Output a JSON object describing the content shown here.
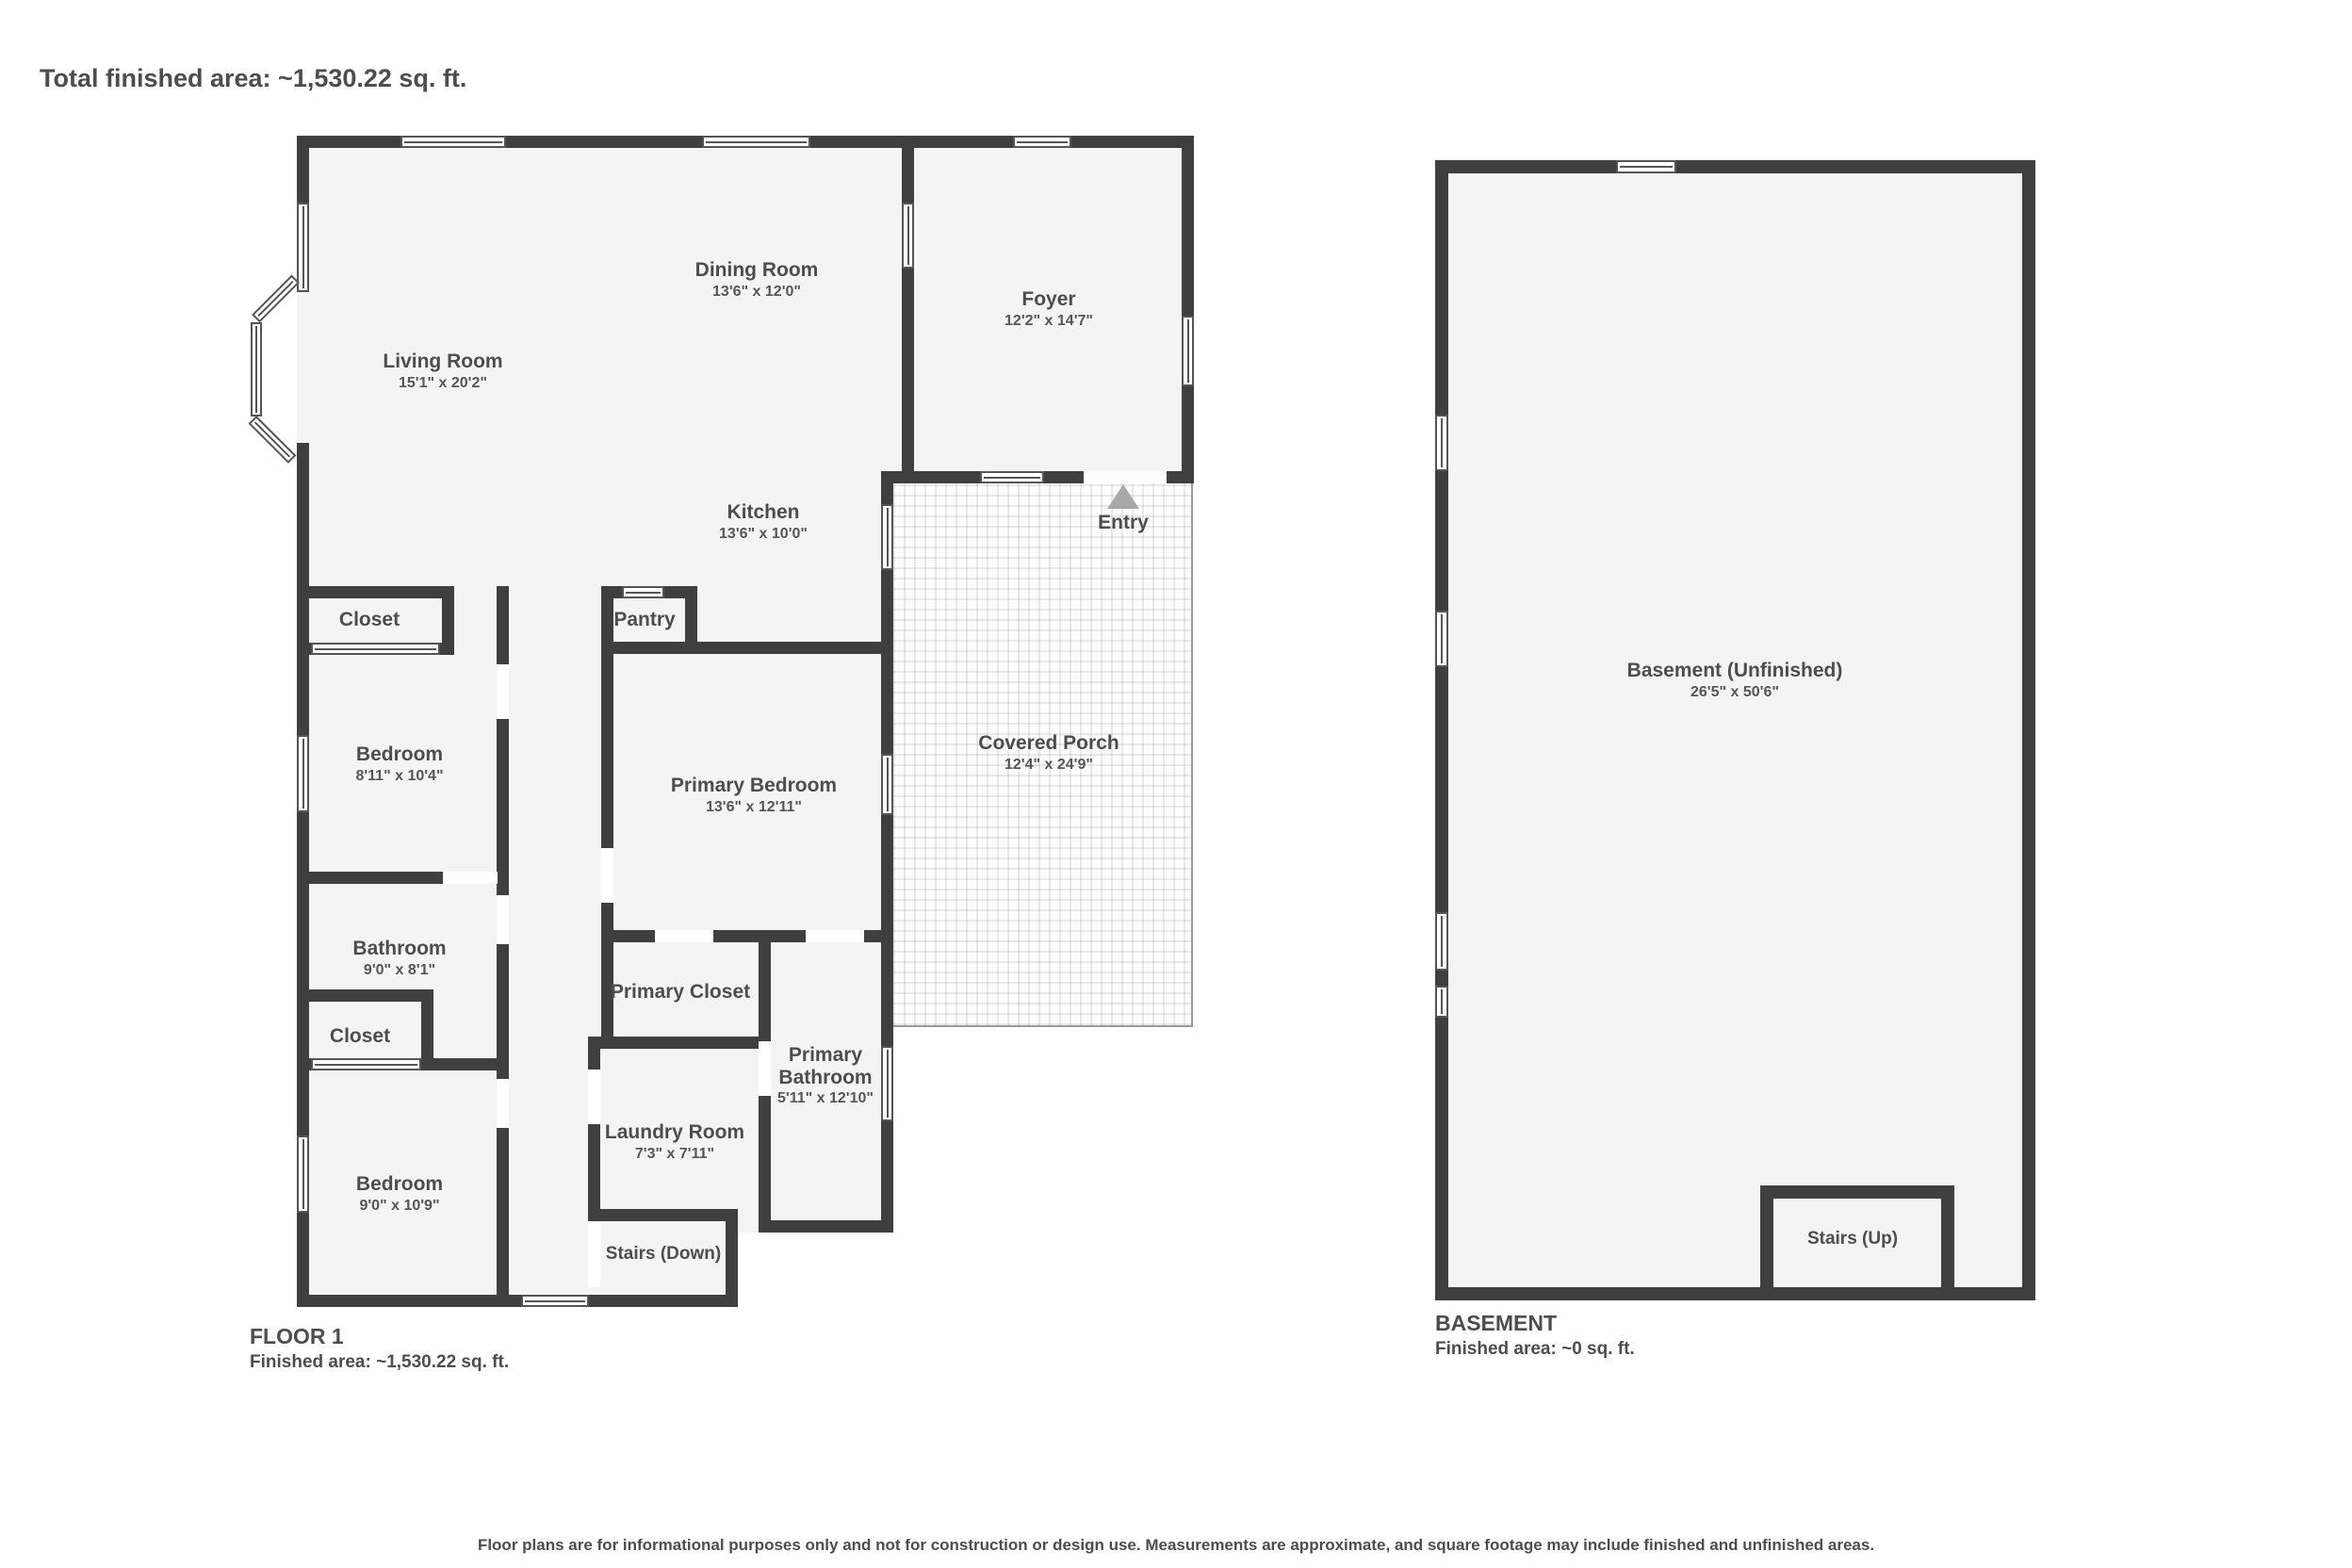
{
  "title": "Total finished area: ~1,530.22 sq. ft.",
  "colors": {
    "wall": "#3f3f3f",
    "floor": "#f4f4f4",
    "text": "#4d4d4d",
    "porch_line": "#9a9a9a",
    "entry_arrow": "#a8a8a8"
  },
  "floor1": {
    "label": "FLOOR 1",
    "area_label": "Finished area: ~1,530.22 sq. ft.",
    "rooms": {
      "living": {
        "name": "Living Room",
        "dims": "15'1\" x 20'2\""
      },
      "dining": {
        "name": "Dining Room",
        "dims": "13'6\" x 12'0\""
      },
      "foyer": {
        "name": "Foyer",
        "dims": "12'2\" x 14'7\""
      },
      "kitchen": {
        "name": "Kitchen",
        "dims": "13'6\" x 10'0\""
      },
      "entry": {
        "name": "Entry"
      },
      "porch": {
        "name": "Covered Porch",
        "dims": "12'4\" x 24'9\""
      },
      "closet_top": {
        "name": "Closet"
      },
      "pantry": {
        "name": "Pantry"
      },
      "bedroom1": {
        "name": "Bedroom",
        "dims": "8'11\" x 10'4\""
      },
      "primary_bedroom": {
        "name": "Primary Bedroom",
        "dims": "13'6\" x 12'11\""
      },
      "bathroom": {
        "name": "Bathroom",
        "dims": "9'0\" x 8'1\""
      },
      "closet_mid": {
        "name": "Closet"
      },
      "primary_closet": {
        "name": "Primary Closet"
      },
      "primary_bathroom": {
        "name": "Primary Bathroom",
        "dims": "5'11\" x 12'10\""
      },
      "bedroom2": {
        "name": "Bedroom",
        "dims": "9'0\" x 10'9\""
      },
      "laundry": {
        "name": "Laundry Room",
        "dims": "7'3\" x 7'11\""
      },
      "stairs_down": {
        "name": "Stairs (Down)"
      }
    }
  },
  "basement": {
    "label": "BASEMENT",
    "area_label": "Finished area: ~0 sq. ft.",
    "rooms": {
      "basement": {
        "name": "Basement (Unfinished)",
        "dims": "26'5\" x 50'6\""
      },
      "stairs_up": {
        "name": "Stairs (Up)"
      }
    }
  },
  "footer": "Floor plans are for informational purposes only and not for construction or design use. Measurements are approximate, and square footage may include finished and unfinished areas."
}
